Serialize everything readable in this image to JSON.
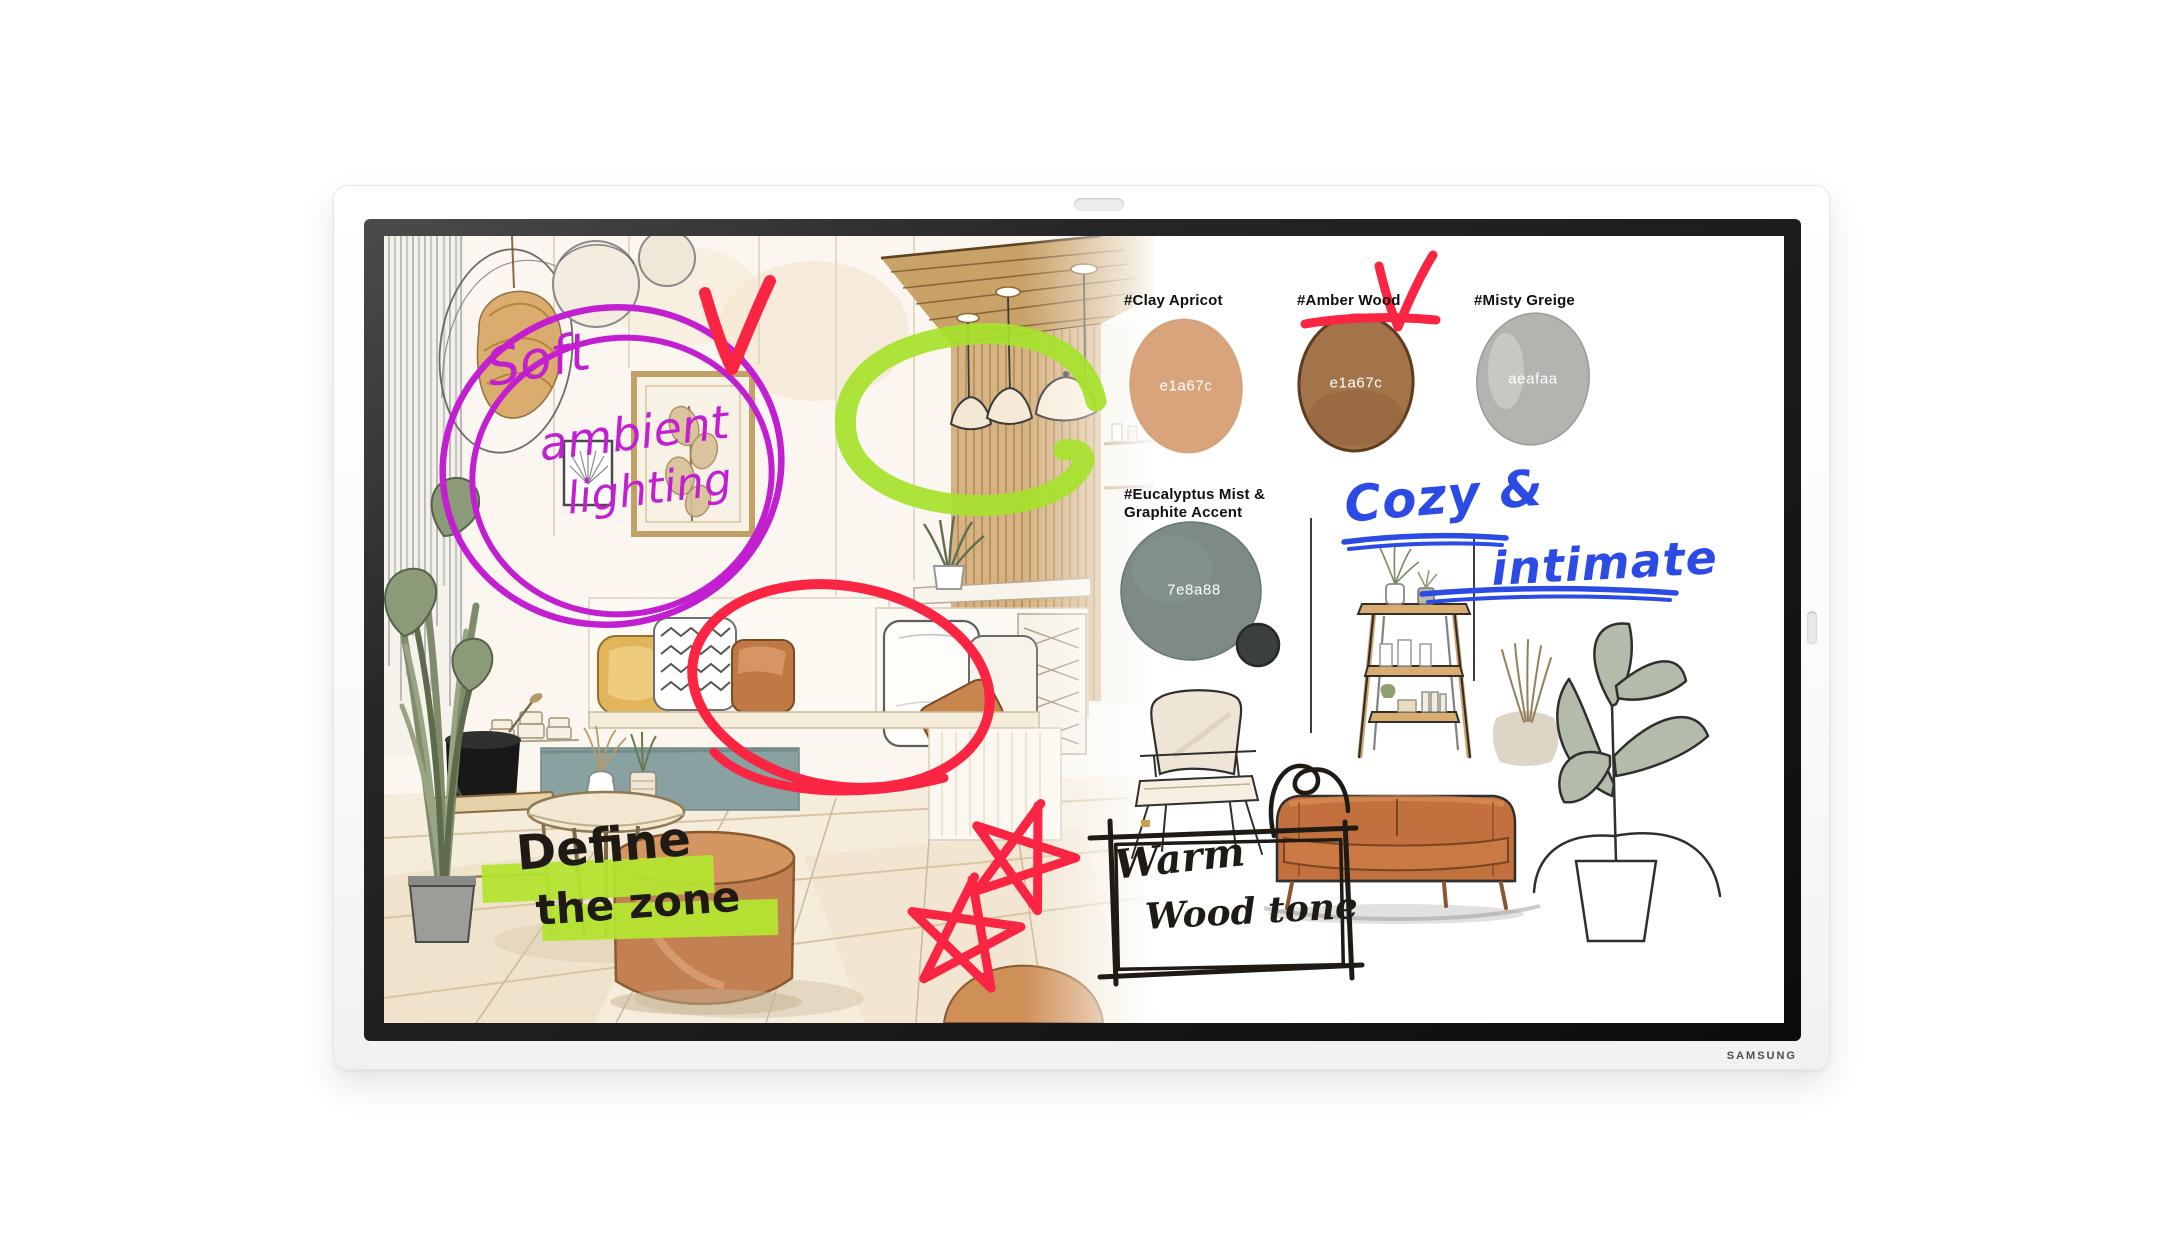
{
  "device": {
    "brand_label": "SAMSUNG"
  },
  "whiteboard": {
    "swatches": [
      {
        "label": "#Clay Apricot",
        "hex_label": "e1a67c",
        "fill": "#d9a47c"
      },
      {
        "label": "#Amber Wood",
        "hex_label": "e1a67c",
        "fill": "#a3734a"
      },
      {
        "label": "#Misty Greige",
        "hex_label": "aeafaa",
        "fill": "#b2b4af"
      },
      {
        "label_line1": "#Eucalyptus Mist &",
        "label_line2": "Graphite Accent",
        "hex_label": "7e8a88",
        "fill": "#7d8a86",
        "accent_fill": "#3b403f"
      }
    ],
    "handwritten": {
      "soft_line1": "Soft",
      "soft_line2": "ambient",
      "soft_line3": "lighting",
      "define_line1": "Define",
      "define_line2": "the zone",
      "warm_line1": "Warm",
      "warm_line2": "Wood tone",
      "cozy_line1": "Cozy &",
      "cozy_line2": "intimate"
    },
    "marker_colors": {
      "red": "#fa2443",
      "green": "#a6e22b",
      "purple": "#c21fd1",
      "blue": "#2b4be4",
      "highlight": "#b4e430",
      "ink": "#1f1a14"
    }
  }
}
